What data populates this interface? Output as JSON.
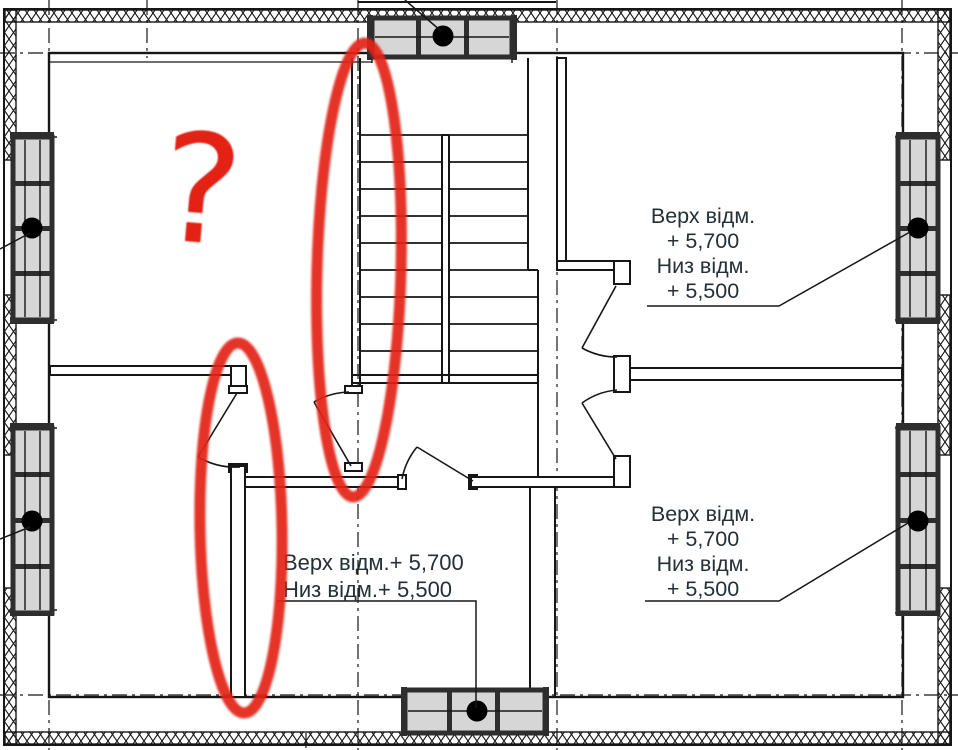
{
  "annotations": {
    "question_mark": "?",
    "elevation_top_right": {
      "lines": [
        "Верх відм.",
        "+ 5,700",
        "Низ відм.",
        "+ 5,500"
      ]
    },
    "elevation_bottom_right": {
      "lines": [
        "Верх відм.",
        "+ 5,700",
        "Низ відм.",
        "+ 5,500"
      ]
    },
    "elevation_bottom_center": {
      "lines": [
        "Верх відм.+ 5,700",
        "Низ відм.+ 5,500"
      ]
    }
  },
  "colors": {
    "background": "#ffffff",
    "line": "#161616",
    "text": "#243036",
    "marker_red": "#e32114",
    "window_pane": "#d6d6d6",
    "window_frame": "#2e2e2e"
  },
  "icons": {
    "window_reference_dot": "filled-circle",
    "question_mark_marker": "hand-drawn-question-mark"
  }
}
